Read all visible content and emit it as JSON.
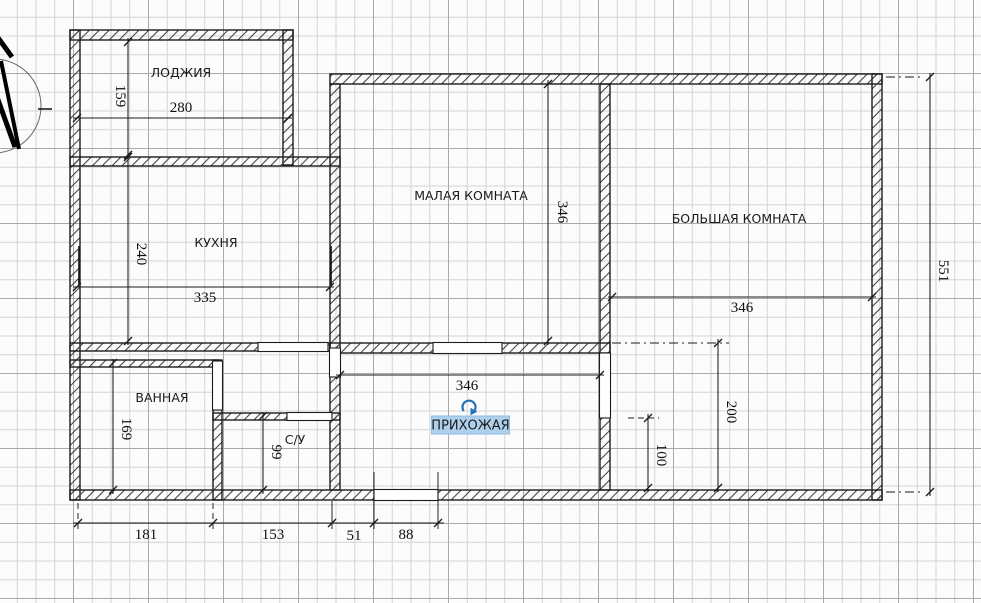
{
  "plan": {
    "rooms": {
      "loggia": {
        "label": "ЛОДЖИЯ"
      },
      "kitchen": {
        "label": "КУХНЯ"
      },
      "small_room": {
        "label": "МАЛАЯ КОМНАТА"
      },
      "big_room": {
        "label": "БОЛЬШАЯ КОМНАТА"
      },
      "bathroom": {
        "label": "ВАННАЯ"
      },
      "wc": {
        "label": "С/У"
      },
      "hallway": {
        "label": "ПРИХОЖАЯ"
      }
    },
    "dimensions": {
      "loggia_width": "280",
      "loggia_height": "159",
      "kitchen_width": "335",
      "kitchen_height": "240",
      "small_room_height": "346",
      "big_room_width": "346",
      "hallway_width": "346",
      "overall_height_right": "551",
      "bathroom_height": "169",
      "wc_height": "99",
      "big_room_right_wall": "200",
      "big_room_lower_wall": "100",
      "bottom_segment_1": "181",
      "bottom_segment_2": "153",
      "bottom_segment_3": "51",
      "bottom_segment_4": "88"
    },
    "selection": {
      "selected_label": "ПРИХОЖАЯ",
      "highlight_color": "#aed0ec",
      "handle_color": "#2272b9"
    },
    "icons": {
      "rotate_handle": "rotate-arrow-icon",
      "north_indicator": "compass-north-arrow"
    },
    "colors": {
      "wall_outline": "#1c1c1c",
      "wall_hatch": "#3f3f3f",
      "dimension_text": "#101010",
      "grid_minor": "#d4d4d4",
      "grid_major": "#a9a9a9",
      "background": "#fcfcfc"
    }
  }
}
